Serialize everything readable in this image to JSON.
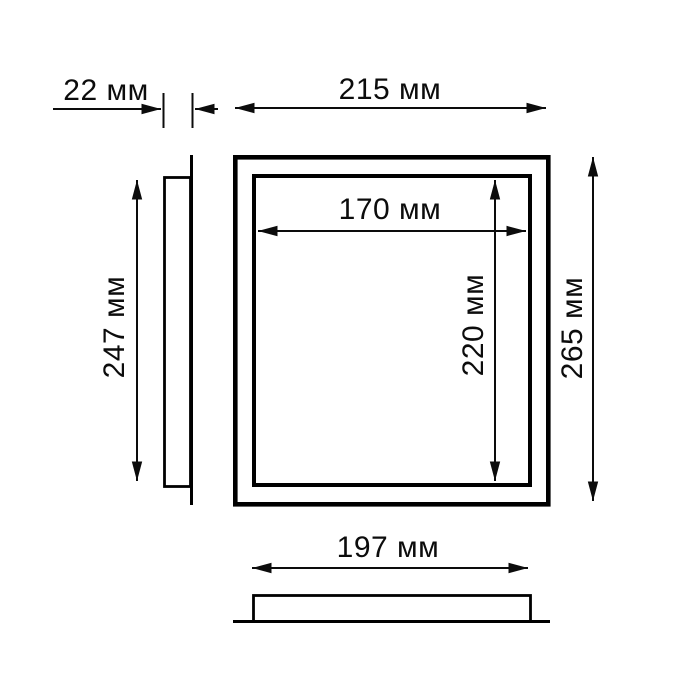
{
  "drawing": {
    "unit": "мм",
    "labels": {
      "depth": "22 мм",
      "outer_width": "215 мм",
      "inner_width": "170 мм",
      "inner_height": "220 мм",
      "outer_height": "265 мм",
      "side_height": "247 мм",
      "base_width": "197 мм"
    },
    "values_mm": {
      "depth": 22,
      "outer_width": 215,
      "inner_width": 170,
      "inner_height": 220,
      "outer_height": 265,
      "side_height": 247,
      "base_width": 197
    },
    "colors": {
      "line": "#000000",
      "text": "#0c0c0c",
      "background": "#ffffff"
    }
  }
}
